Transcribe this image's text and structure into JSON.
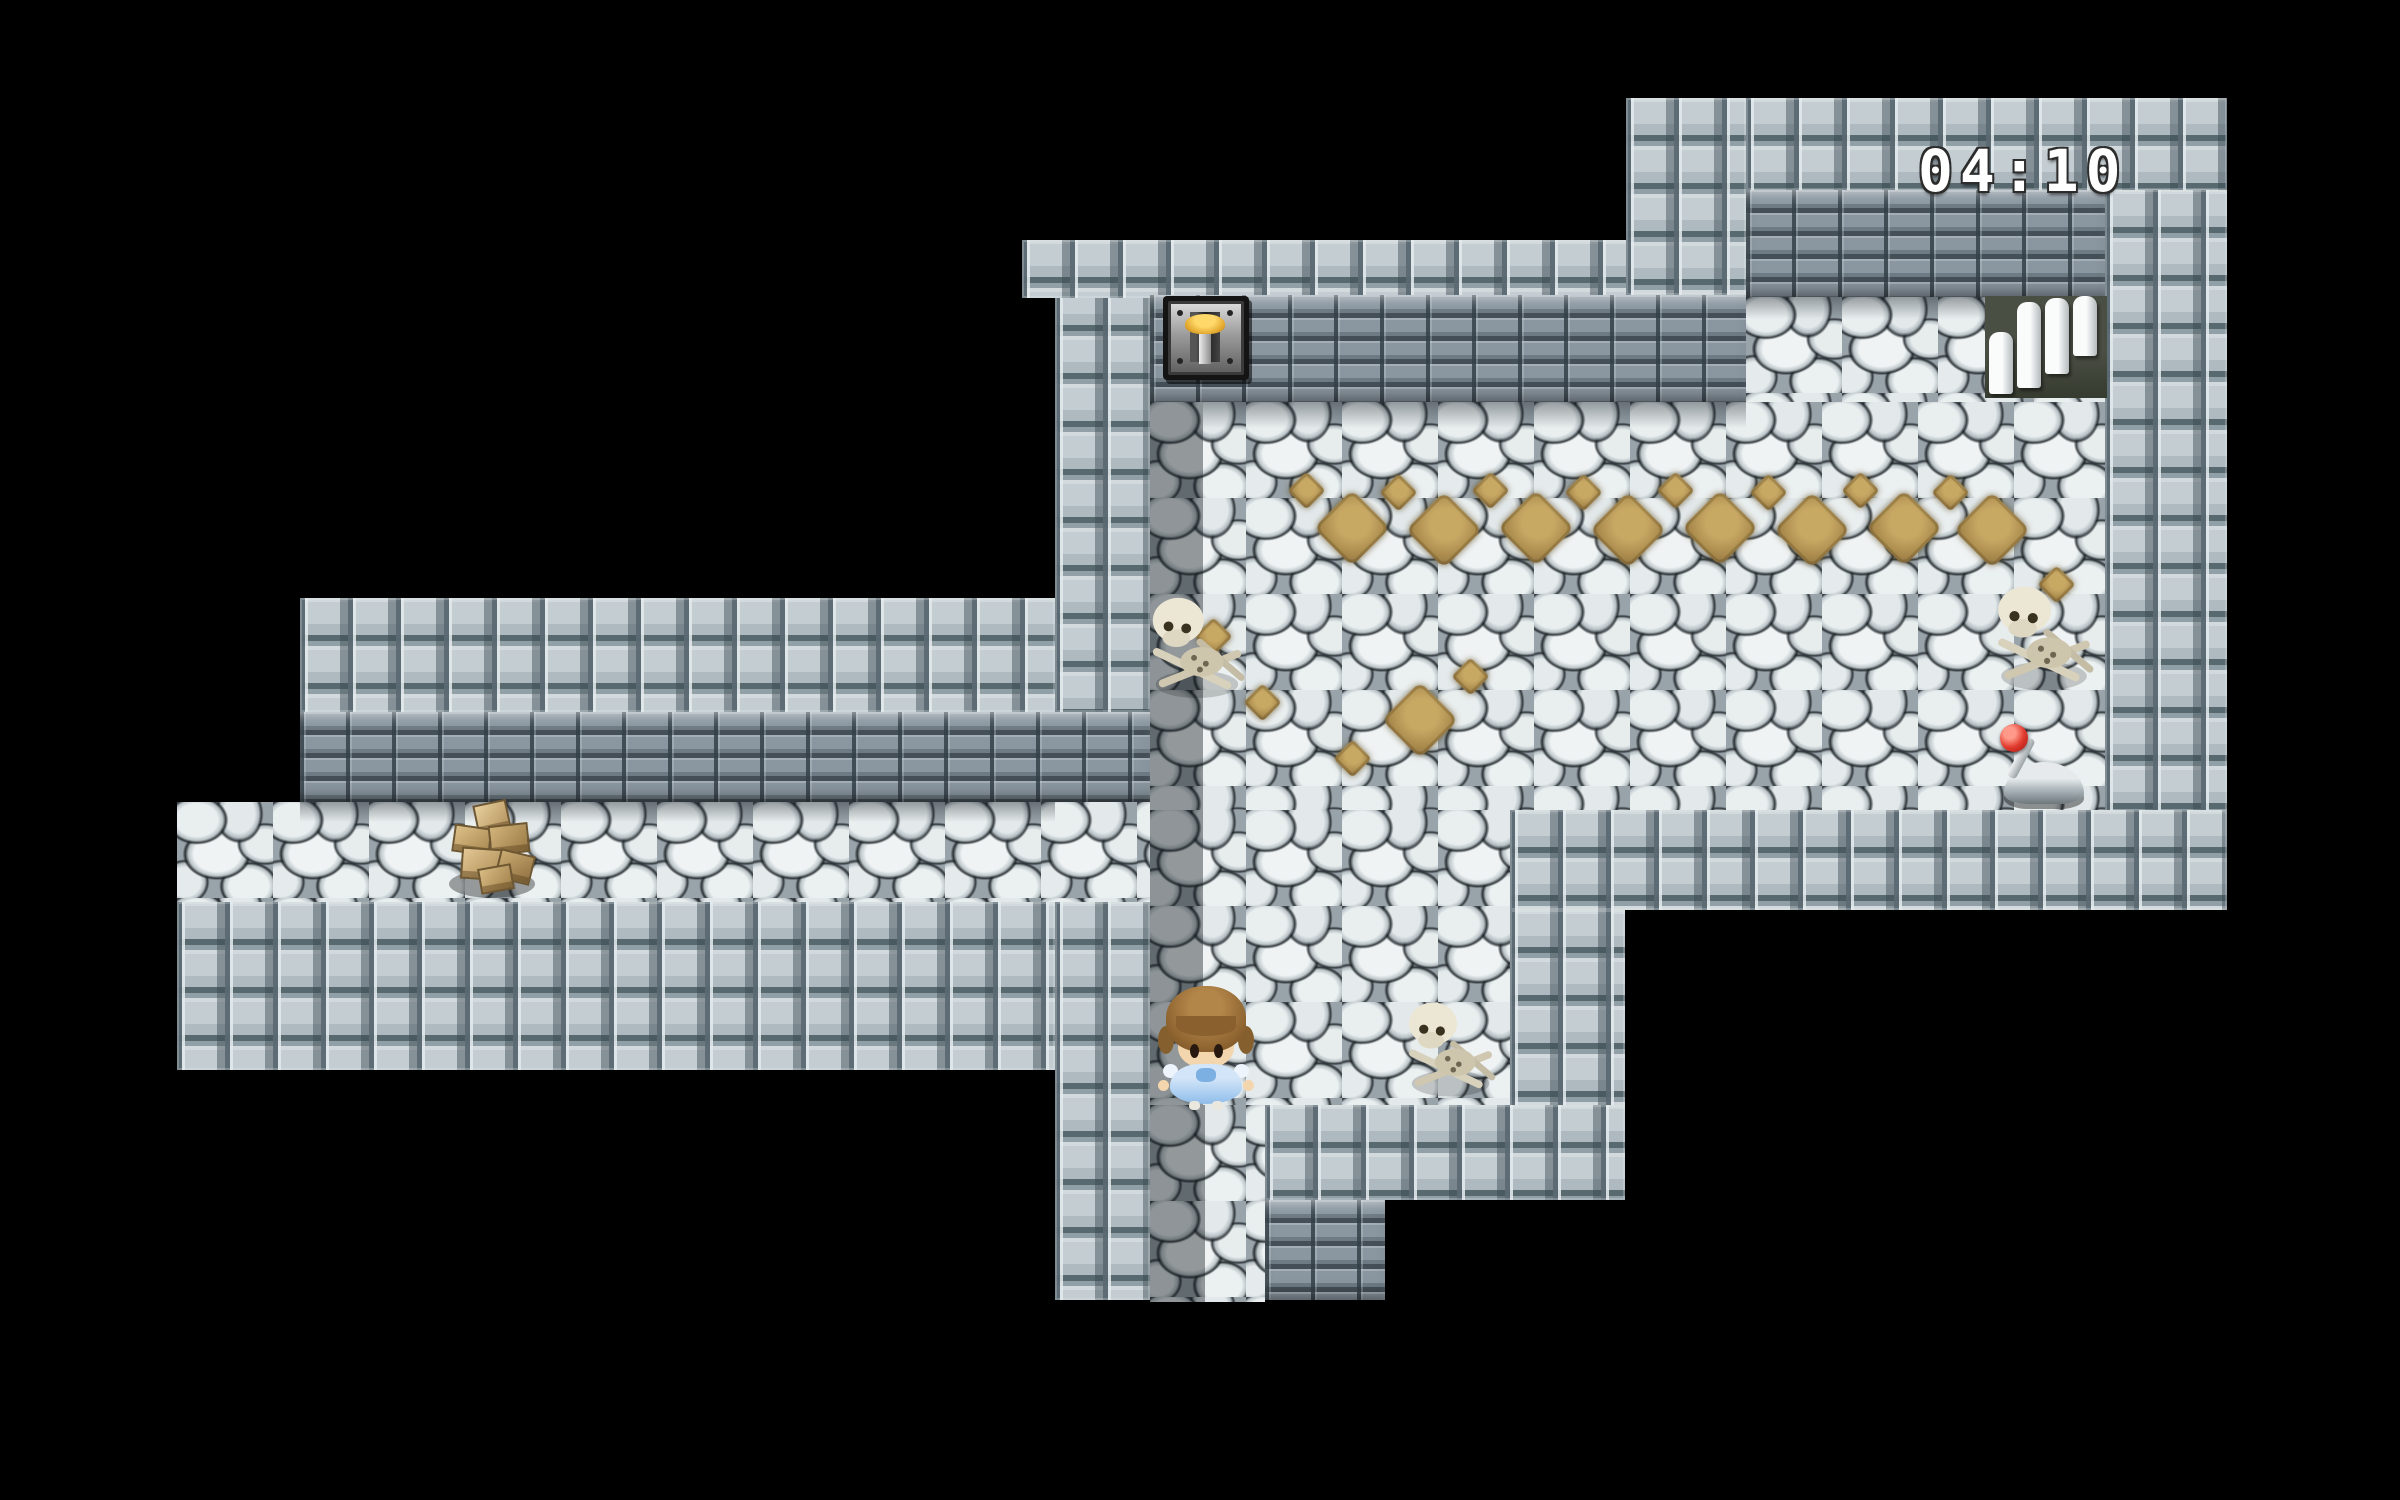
{
  "screen": {
    "width": 2400,
    "height": 1500,
    "background": "#000000"
  },
  "hud": {
    "timer": {
      "label": "04:10",
      "color": "#ffffff",
      "outline_color": "#2c2c2c"
    }
  },
  "scene": {
    "tileset": "stone-dungeon",
    "palette": {
      "wall_top": "#c3cdd2",
      "wall_mortar": "#58696f",
      "wall_brick": "#8a96a0",
      "floor_stone": "#e9eeef",
      "floor_gap": "#99a4aa",
      "diamond_brown": "#ab8b4d",
      "lever_gold": "#e3a92f",
      "orb_red": "#e03a2d",
      "rubble_tan": "#c9ab74",
      "background": "#000000"
    },
    "entities": [
      {
        "id": "timer",
        "label": "04:10",
        "kind": "hud-timer",
        "x": 1918,
        "y": 142,
        "w": 260,
        "h": 60
      },
      {
        "id": "wall-lever",
        "label": "wall lever switch",
        "kind": "switch",
        "x": 1163,
        "y": 296,
        "w": 86,
        "h": 84
      },
      {
        "id": "stairs",
        "label": "stairs up",
        "kind": "stairs",
        "x": 1985,
        "y": 296,
        "w": 122,
        "h": 102
      },
      {
        "id": "skeleton-1",
        "label": "skeleton remains",
        "kind": "skeleton",
        "x": 1143,
        "y": 590,
        "w": 108,
        "h": 115
      },
      {
        "id": "skeleton-2",
        "label": "skeleton remains",
        "kind": "skeleton",
        "x": 1988,
        "y": 578,
        "w": 112,
        "h": 120
      },
      {
        "id": "skeleton-3",
        "label": "skeleton remains",
        "kind": "skeleton",
        "x": 1393,
        "y": 996,
        "w": 115,
        "h": 106
      },
      {
        "id": "rubble",
        "label": "rubble pile",
        "kind": "debris",
        "x": 445,
        "y": 800,
        "w": 95,
        "h": 105
      },
      {
        "id": "floor-lever",
        "label": "lever with red orb",
        "kind": "switch",
        "x": 1992,
        "y": 724,
        "w": 104,
        "h": 86
      },
      {
        "id": "player",
        "label": "player character",
        "kind": "player",
        "x": 1160,
        "y": 982,
        "w": 92,
        "h": 128
      }
    ],
    "floor_markings": {
      "big": [
        [
          1352,
          528
        ],
        [
          1444,
          530
        ],
        [
          1536,
          528
        ],
        [
          1628,
          530
        ],
        [
          1720,
          528
        ],
        [
          1812,
          530
        ],
        [
          1904,
          528
        ],
        [
          1992,
          530
        ],
        [
          1420,
          720
        ]
      ],
      "small": [
        [
          1306,
          490
        ],
        [
          1398,
          492
        ],
        [
          1490,
          490
        ],
        [
          1583,
          492
        ],
        [
          1675,
          490
        ],
        [
          1768,
          492
        ],
        [
          1860,
          490
        ],
        [
          1950,
          492
        ],
        [
          1213,
          636
        ],
        [
          1262,
          702
        ],
        [
          1352,
          758
        ],
        [
          1470,
          676
        ],
        [
          2056,
          584
        ]
      ]
    }
  }
}
